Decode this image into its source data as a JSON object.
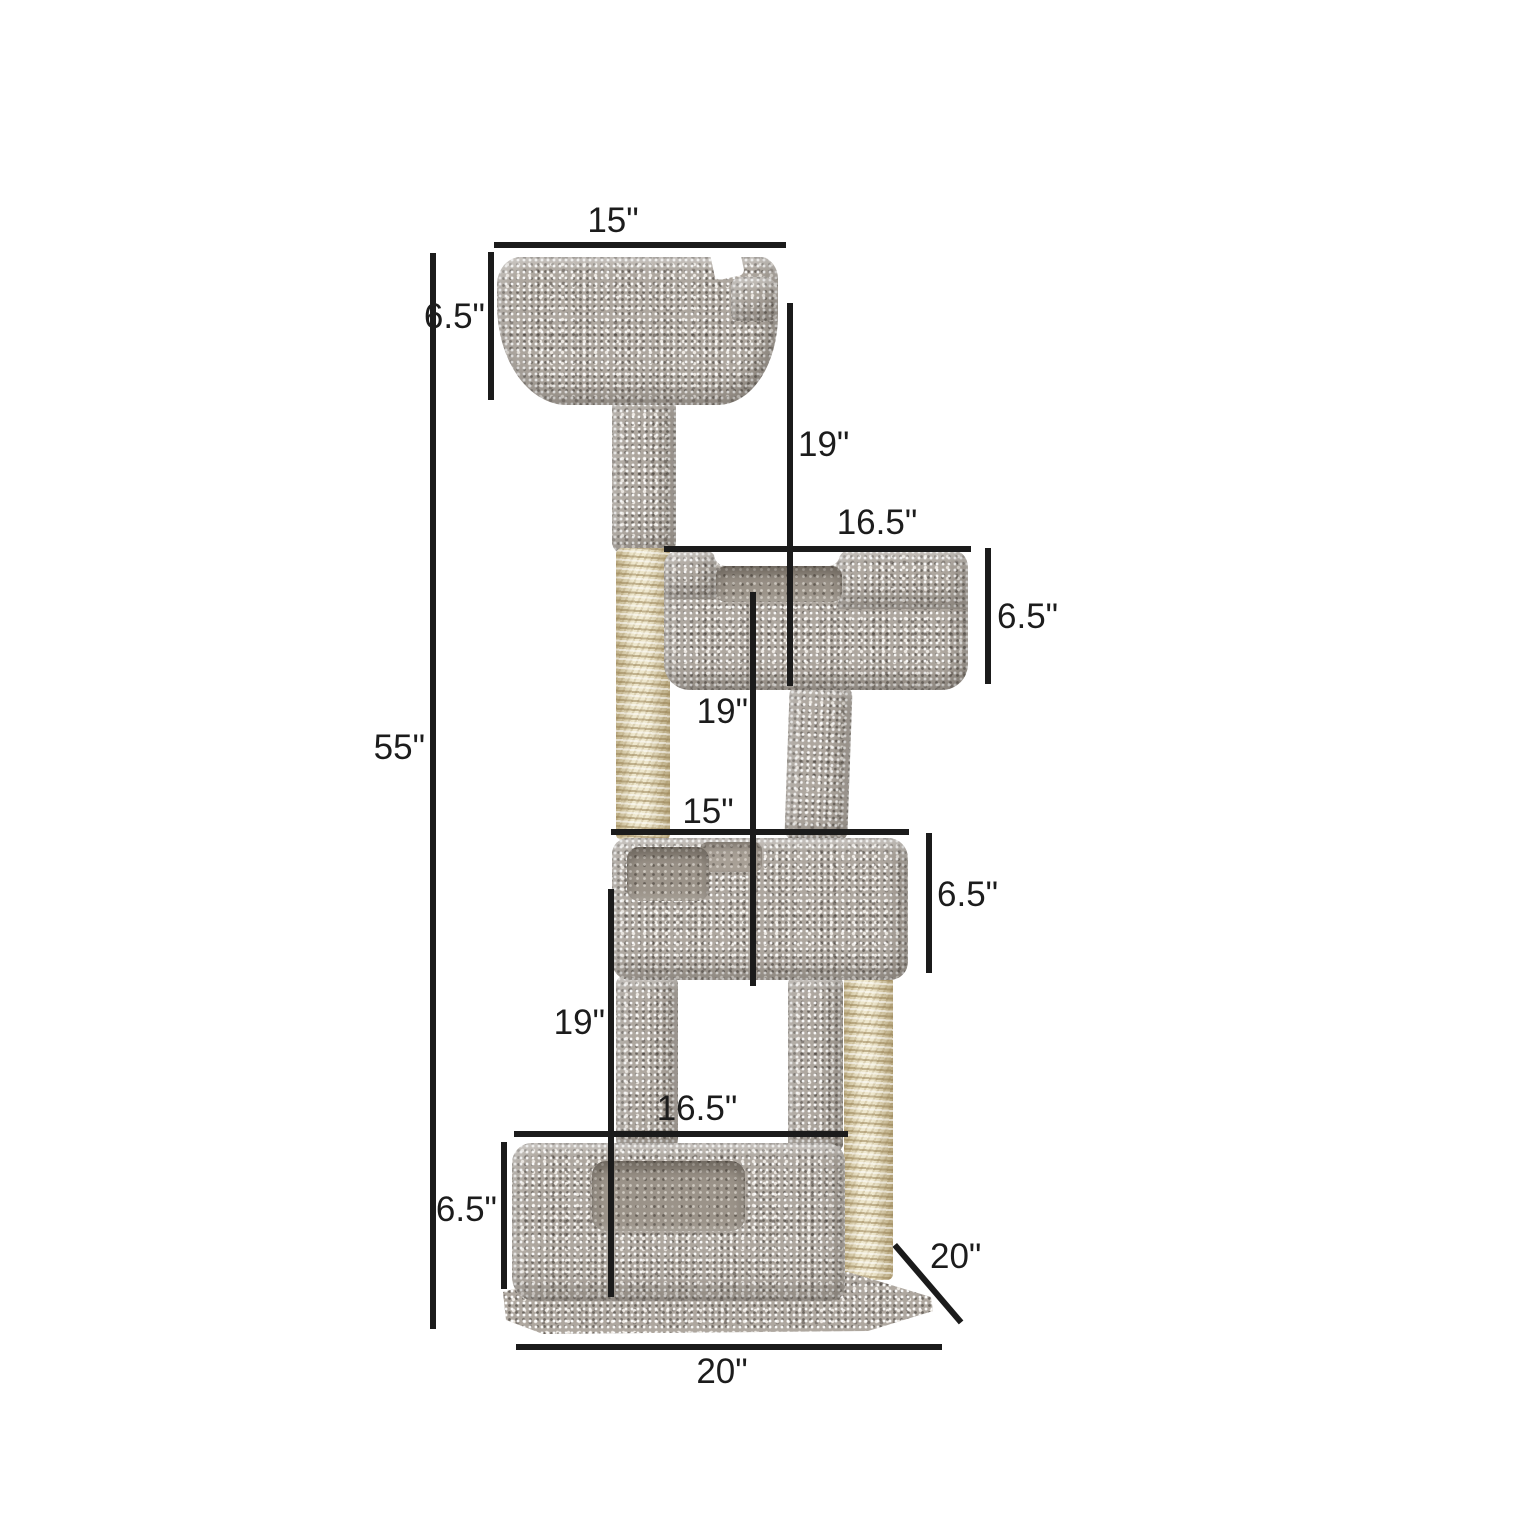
{
  "colors": {
    "background": "#ffffff",
    "dimension_line": "#1b1b1b",
    "label_text": "#1c1c1c",
    "carpet_gray": "#aea79f",
    "carpet_seat_shadow": "#9b9389",
    "sisal_beige": "#e8deba"
  },
  "dims": {
    "top_width": "15\"",
    "top_bed_height": "6.5\"",
    "total_height": "55\"",
    "top_gap_height": "19\"",
    "second_width": "16.5\"",
    "second_bed_height": "6.5\"",
    "second_gap_height": "19\"",
    "third_width": "15\"",
    "third_bed_height": "6.5\"",
    "third_gap_height": "19\"",
    "base_bed_width": "16.5\"",
    "base_bed_height": "6.5\"",
    "base_depth": "20\"",
    "base_width": "20\""
  }
}
